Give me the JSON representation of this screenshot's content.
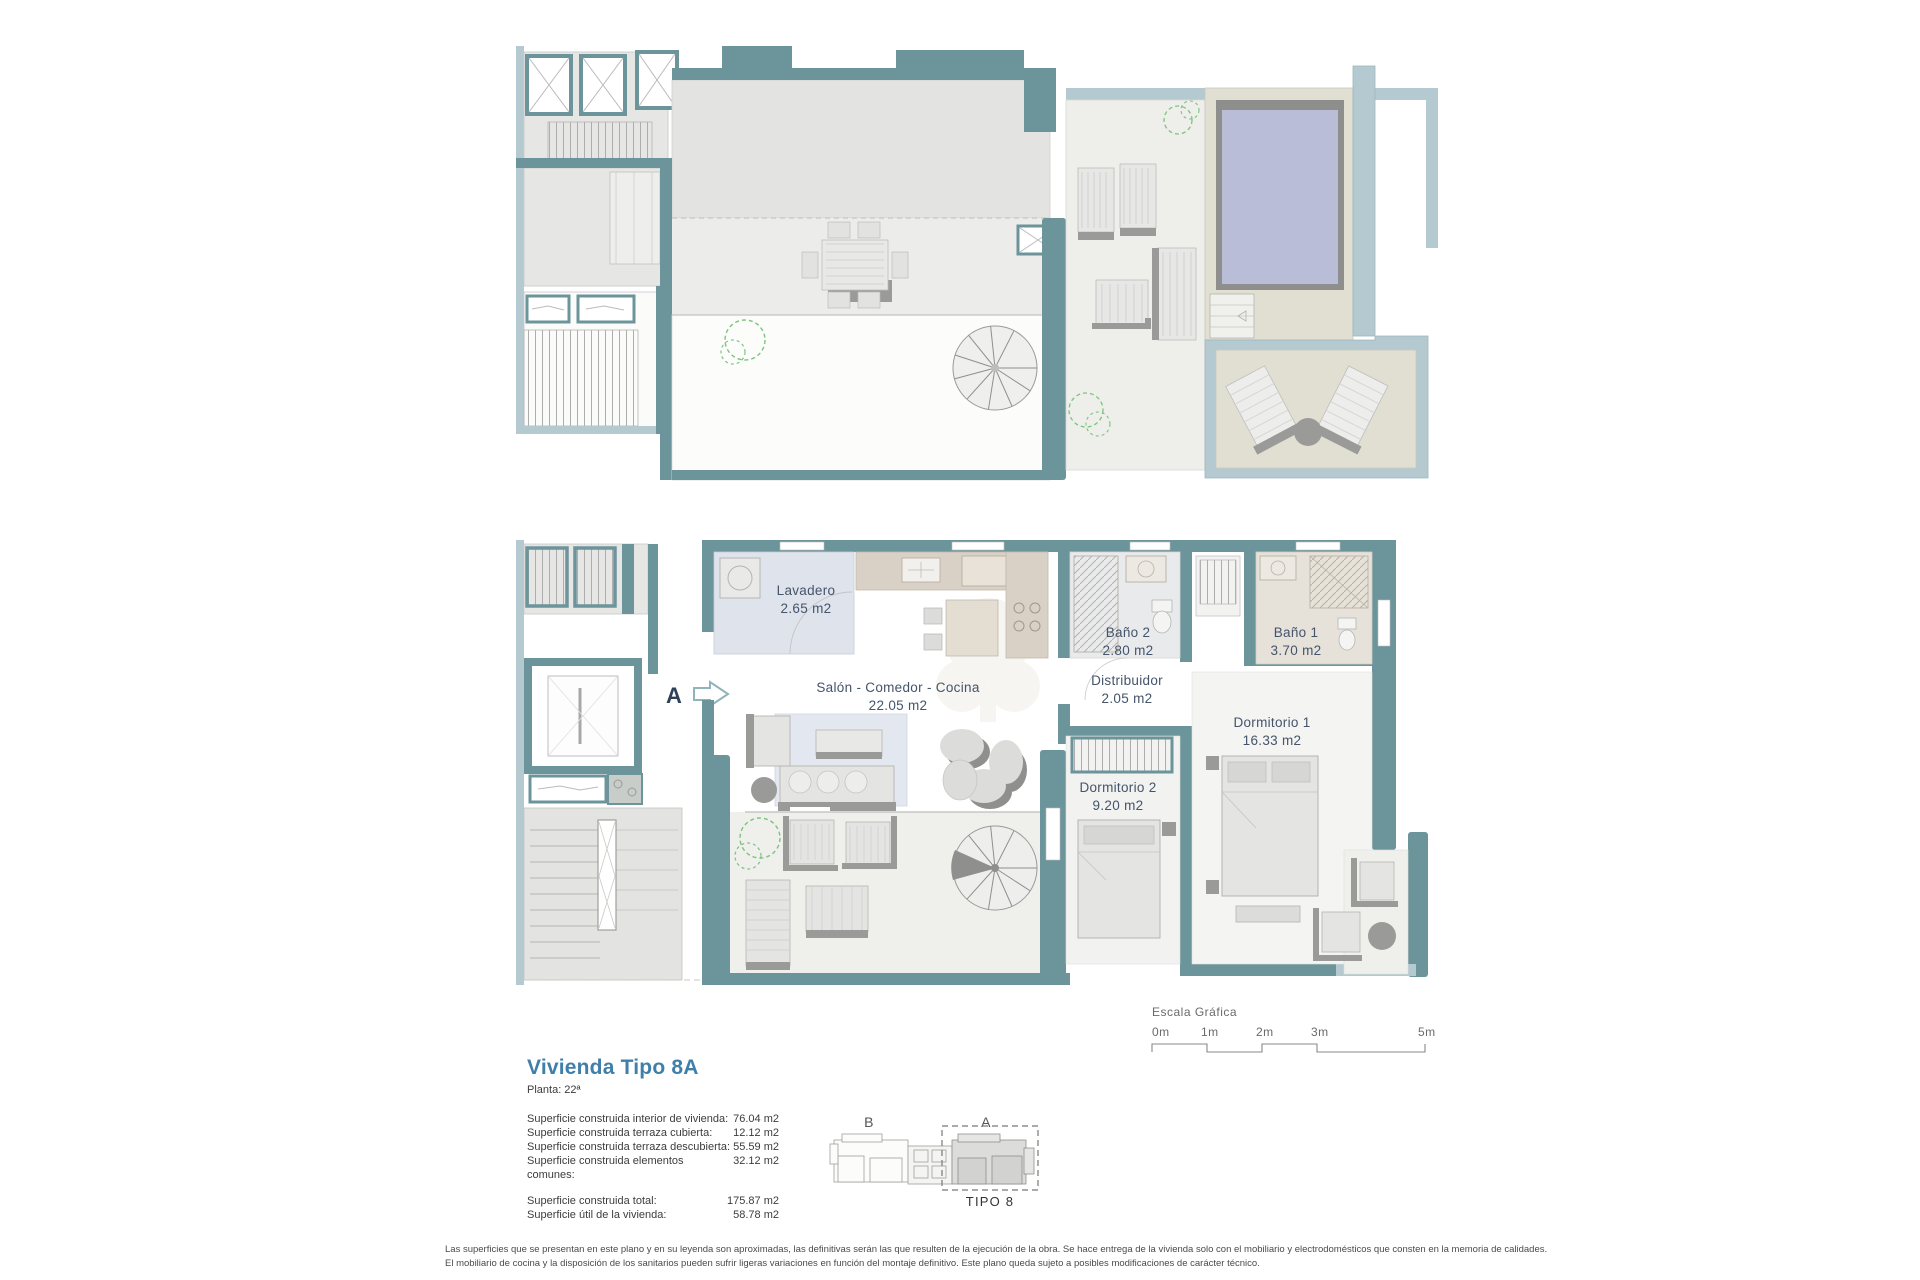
{
  "apartment_plan": {
    "section_marker": "A",
    "rooms": [
      {
        "name": "Lavadero",
        "area": "2.65 m2"
      },
      {
        "name": "Salón - Comedor - Cocina",
        "area": "22.05 m2"
      },
      {
        "name": "Baño 2",
        "area": "2.80 m2"
      },
      {
        "name": "Baño 1",
        "area": "3.70 m2"
      },
      {
        "name": "Distribuidor",
        "area": "2.05 m2"
      },
      {
        "name": "Dormitorio 2",
        "area": "9.20 m2"
      },
      {
        "name": "Dormitorio 1",
        "area": "16.33 m2"
      }
    ]
  },
  "scale_bar": {
    "title": "Escala Gráfica",
    "ticks": [
      "0m",
      "1m",
      "2m",
      "3m",
      "5m"
    ]
  },
  "key_plan": {
    "label_b": "B",
    "label_a": "A",
    "caption": "TIPO 8"
  },
  "title_block": {
    "title": "Vivienda Tipo 8A",
    "subtitle": "Planta: 22ª",
    "rows": [
      {
        "label": "Superficie construida interior de vivienda:",
        "value": "76.04 m2"
      },
      {
        "label": "Superficie construida terraza cubierta:",
        "value": "12.12 m2"
      },
      {
        "label": "Superficie construida terraza descubierta:",
        "value": "55.59 m2"
      },
      {
        "label": "Superficie construida elementos comunes:",
        "value": "32.12 m2"
      }
    ],
    "totals": [
      {
        "label": "Superficie construida total:",
        "value": "175.87 m2"
      },
      {
        "label": "Superficie útil de la vivienda:",
        "value": "58.78 m2"
      }
    ]
  },
  "disclaimer": {
    "line1": "Las superficies que se presentan en este plano y en su leyenda son aproximadas, las definitivas serán las que resulten de la ejecución de la obra. Se hace entrega de la vivienda solo con el mobiliario y electrodomésticos que consten en la memoria de calidades.",
    "line2": "El mobiliario de cocina y la disposición de los sanitarios pueden sufrir ligeras variaciones en función del montaje definitivo. Este plano queda sujeto a posibles modificaciones de carácter técnico."
  },
  "colors": {
    "wall_teal": "#6b949b",
    "wall_light": "#b5cad0",
    "pool": "#b9bdd8",
    "deck": "#e0dfd2",
    "floor": "#e6e7e4",
    "floor_light": "#f0f0ed",
    "title_accent": "#3f7fa9",
    "label_text": "#44546a",
    "plant_green": "#7cc47e"
  }
}
